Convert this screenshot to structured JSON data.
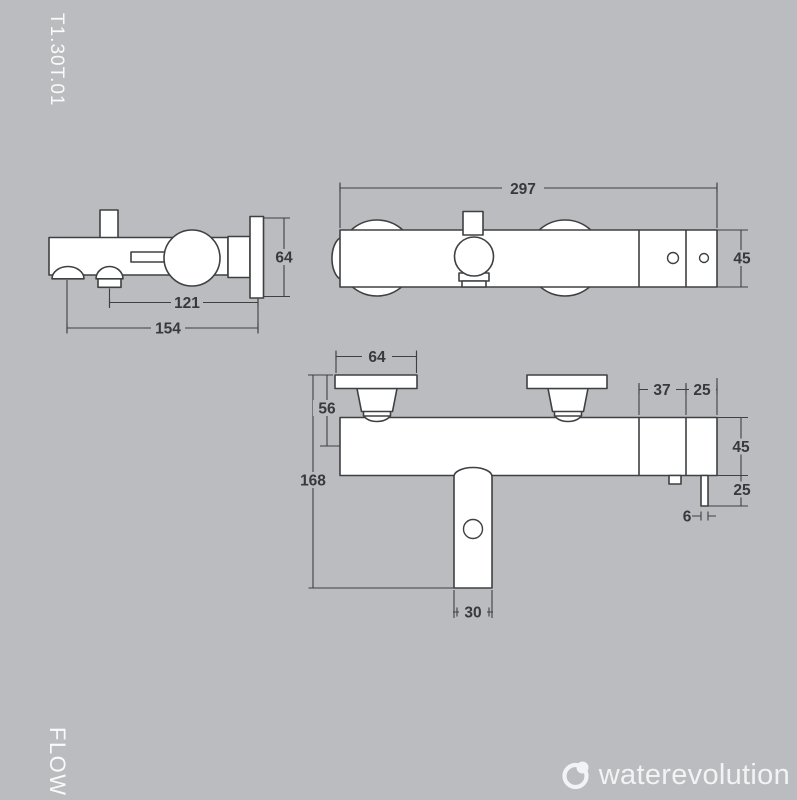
{
  "page": {
    "product_code": "T1.30T.01",
    "series_label": "FLOW",
    "bg_color": "#babcbf",
    "line_color": "#3f4042",
    "shape_fill_color": "#ffffff",
    "dim_text_color": "#39393b",
    "light_text_color": "#f2f3f4"
  },
  "logo": {
    "name": "waterevolution"
  },
  "side_view": {
    "dims": {
      "spout_center_to_wall": "121",
      "shower_outlet_to_wall": "154",
      "plate_height": "64"
    }
  },
  "top_view": {
    "dims": {
      "total_width": "297",
      "body_depth": "45"
    }
  },
  "front_view": {
    "dims": {
      "plate_width": "64",
      "plate_to_body_center": "56",
      "total_height": "168",
      "spout_width": "30",
      "cartridge_section": "37",
      "end_section": "25",
      "body_height": "45",
      "outlet_drop": "25",
      "outlet_width": "6"
    }
  }
}
